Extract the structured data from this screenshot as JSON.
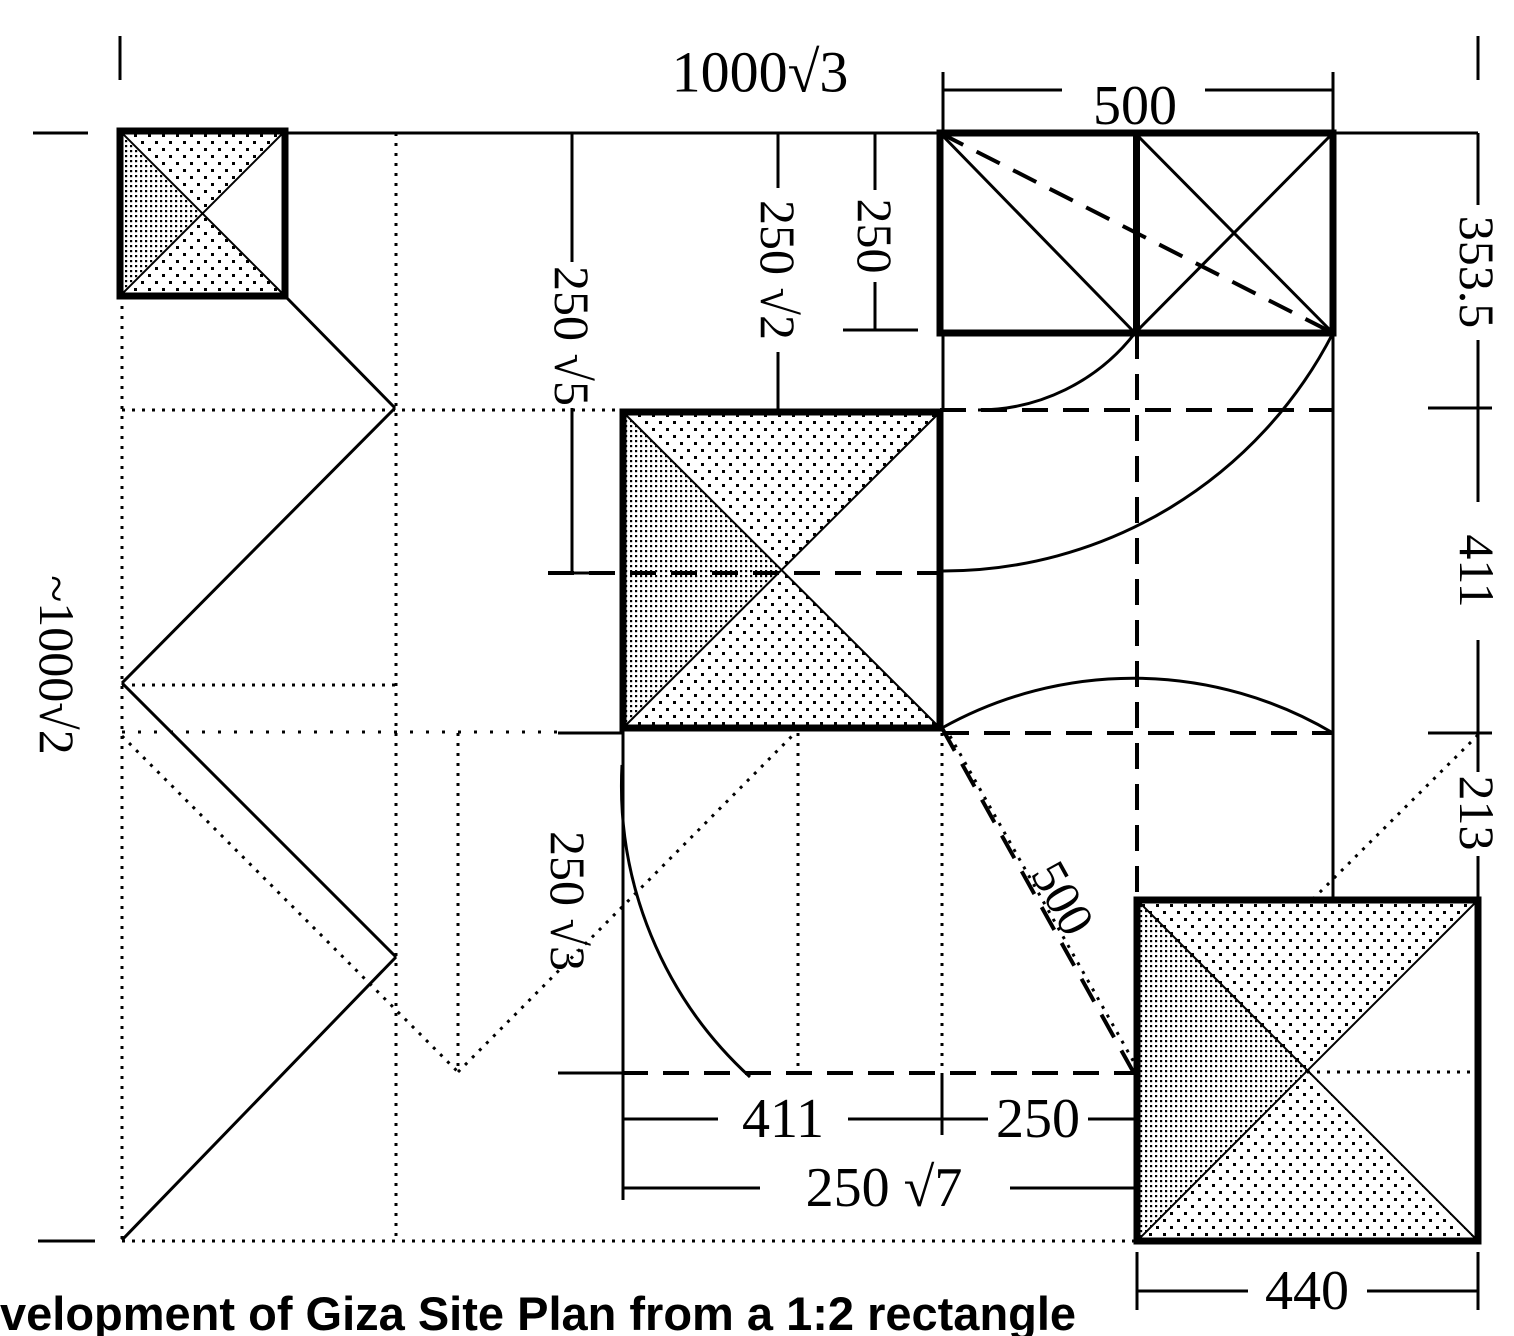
{
  "caption": "velopment of Giza Site Plan from a 1:2 rectangle",
  "colors": {
    "ink": "#000000",
    "background": "#ffffff"
  },
  "labels": {
    "top_width": "1000√3",
    "top_500": "500",
    "col_250sqrt5": "250 √5",
    "col_250sqrt2": "250 √2",
    "col_250": "250",
    "right_353_5": "353.5",
    "right_411": "411",
    "right_213": "213",
    "left_height": "~1000√2",
    "col_250sqrt3": "250 √3",
    "diag_500": "500",
    "bottom_411": "411",
    "bottom_250": "250",
    "bottom_250sqrt7": "250 √7",
    "bottom_440": "440"
  },
  "geometry": {
    "rects": [
      {
        "x": 940,
        "y": 133,
        "w": 393,
        "h": 200,
        "divider": true
      }
    ],
    "squares": [
      {
        "x": 120,
        "y": 131,
        "w": 165,
        "h": 165
      },
      {
        "x": 623,
        "y": 412,
        "w": 317,
        "h": 316
      },
      {
        "x": 1137,
        "y": 900,
        "w": 341,
        "h": 341
      }
    ],
    "lines": [
      {
        "x1": 33,
        "y1": 133,
        "x2": 88,
        "y2": 133,
        "s": "solid"
      },
      {
        "x1": 122,
        "y1": 133,
        "x2": 1478,
        "y2": 133,
        "s": "solid"
      },
      {
        "x1": 120,
        "y1": 36,
        "x2": 120,
        "y2": 80,
        "s": "solid"
      },
      {
        "x1": 1478,
        "y1": 36,
        "x2": 1478,
        "y2": 80,
        "s": "solid"
      },
      {
        "x1": 943,
        "y1": 72,
        "x2": 943,
        "y2": 133,
        "s": "solid"
      },
      {
        "x1": 1333,
        "y1": 72,
        "x2": 1333,
        "y2": 133,
        "s": "solid"
      },
      {
        "x1": 943,
        "y1": 90,
        "x2": 1062,
        "y2": 90,
        "s": "solid"
      },
      {
        "x1": 1205,
        "y1": 90,
        "x2": 1333,
        "y2": 90,
        "s": "solid"
      },
      {
        "x1": 875,
        "y1": 133,
        "x2": 875,
        "y2": 190,
        "s": "solid"
      },
      {
        "x1": 875,
        "y1": 282,
        "x2": 875,
        "y2": 330,
        "s": "solid"
      },
      {
        "x1": 843,
        "y1": 330,
        "x2": 918,
        "y2": 330,
        "s": "solid"
      },
      {
        "x1": 778,
        "y1": 133,
        "x2": 778,
        "y2": 188,
        "s": "solid"
      },
      {
        "x1": 778,
        "y1": 352,
        "x2": 778,
        "y2": 410,
        "s": "solid"
      },
      {
        "x1": 753,
        "y1": 410,
        "x2": 806,
        "y2": 410,
        "s": "solid"
      },
      {
        "x1": 572,
        "y1": 133,
        "x2": 572,
        "y2": 262,
        "s": "solid"
      },
      {
        "x1": 572,
        "y1": 408,
        "x2": 572,
        "y2": 573,
        "s": "solid"
      },
      {
        "x1": 548,
        "y1": 573,
        "x2": 600,
        "y2": 573,
        "s": "solid"
      },
      {
        "x1": 122,
        "y1": 410,
        "x2": 623,
        "y2": 410,
        "s": "dotted"
      },
      {
        "x1": 940,
        "y1": 410,
        "x2": 1333,
        "y2": 410,
        "s": "dashed"
      },
      {
        "x1": 548,
        "y1": 573,
        "x2": 940,
        "y2": 573,
        "s": "dashed"
      },
      {
        "x1": 122,
        "y1": 685,
        "x2": 396,
        "y2": 685,
        "s": "dotted"
      },
      {
        "x1": 122,
        "y1": 732,
        "x2": 560,
        "y2": 732,
        "s": "sparse"
      },
      {
        "x1": 558,
        "y1": 733,
        "x2": 622,
        "y2": 733,
        "s": "solid"
      },
      {
        "x1": 943,
        "y1": 733,
        "x2": 1333,
        "y2": 733,
        "s": "dashed"
      },
      {
        "x1": 558,
        "y1": 1073,
        "x2": 622,
        "y2": 1073,
        "s": "solid"
      },
      {
        "x1": 622,
        "y1": 1073,
        "x2": 1135,
        "y2": 1073,
        "s": "dashed"
      },
      {
        "x1": 1307,
        "y1": 1072,
        "x2": 1478,
        "y2": 1072,
        "s": "dotted"
      },
      {
        "x1": 122,
        "y1": 1241,
        "x2": 1137,
        "y2": 1241,
        "s": "dotted"
      },
      {
        "x1": 38,
        "y1": 1241,
        "x2": 95,
        "y2": 1241,
        "s": "solid"
      },
      {
        "x1": 122,
        "y1": 296,
        "x2": 122,
        "y2": 1241,
        "s": "dotted"
      },
      {
        "x1": 396,
        "y1": 133,
        "x2": 396,
        "y2": 1241,
        "s": "dotted"
      },
      {
        "x1": 458,
        "y1": 733,
        "x2": 458,
        "y2": 1072,
        "s": "dotted"
      },
      {
        "x1": 798,
        "y1": 733,
        "x2": 798,
        "y2": 1072,
        "s": "dotted"
      },
      {
        "x1": 943,
        "y1": 333,
        "x2": 943,
        "y2": 412,
        "s": "solid"
      },
      {
        "x1": 942,
        "y1": 733,
        "x2": 942,
        "y2": 1073,
        "s": "dotted"
      },
      {
        "x1": 942,
        "y1": 1073,
        "x2": 942,
        "y2": 1135,
        "s": "solid"
      },
      {
        "x1": 623,
        "y1": 728,
        "x2": 623,
        "y2": 1200,
        "s": "solid"
      },
      {
        "x1": 1137,
        "y1": 333,
        "x2": 1137,
        "y2": 898,
        "s": "dashed"
      },
      {
        "x1": 1333,
        "y1": 333,
        "x2": 1333,
        "y2": 898,
        "s": "solid"
      },
      {
        "x1": 1478,
        "y1": 133,
        "x2": 1478,
        "y2": 205,
        "s": "solid"
      },
      {
        "x1": 1478,
        "y1": 340,
        "x2": 1478,
        "y2": 502,
        "s": "solid"
      },
      {
        "x1": 1478,
        "y1": 640,
        "x2": 1478,
        "y2": 772,
        "s": "solid"
      },
      {
        "x1": 1478,
        "y1": 856,
        "x2": 1478,
        "y2": 898,
        "s": "solid"
      },
      {
        "x1": 1428,
        "y1": 408,
        "x2": 1492,
        "y2": 408,
        "s": "solid"
      },
      {
        "x1": 1428,
        "y1": 733,
        "x2": 1492,
        "y2": 733,
        "s": "solid"
      },
      {
        "x1": 623,
        "y1": 1119,
        "x2": 718,
        "y2": 1119,
        "s": "solid"
      },
      {
        "x1": 848,
        "y1": 1119,
        "x2": 988,
        "y2": 1119,
        "s": "solid"
      },
      {
        "x1": 1088,
        "y1": 1119,
        "x2": 1137,
        "y2": 1119,
        "s": "solid"
      },
      {
        "x1": 623,
        "y1": 1188,
        "x2": 760,
        "y2": 1188,
        "s": "solid"
      },
      {
        "x1": 1010,
        "y1": 1188,
        "x2": 1137,
        "y2": 1188,
        "s": "solid"
      },
      {
        "x1": 1137,
        "y1": 1291,
        "x2": 1248,
        "y2": 1291,
        "s": "solid"
      },
      {
        "x1": 1367,
        "y1": 1291,
        "x2": 1478,
        "y2": 1291,
        "s": "solid"
      },
      {
        "x1": 1137,
        "y1": 1252,
        "x2": 1137,
        "y2": 1310,
        "s": "solid"
      },
      {
        "x1": 1478,
        "y1": 1252,
        "x2": 1478,
        "y2": 1310,
        "s": "solid"
      },
      {
        "x1": 285,
        "y1": 296,
        "x2": 395,
        "y2": 408,
        "s": "solid"
      },
      {
        "x1": 395,
        "y1": 408,
        "x2": 122,
        "y2": 683,
        "s": "solid"
      },
      {
        "x1": 122,
        "y1": 683,
        "x2": 396,
        "y2": 957,
        "s": "solid"
      },
      {
        "x1": 396,
        "y1": 957,
        "x2": 122,
        "y2": 1240,
        "s": "solid"
      },
      {
        "x1": 940,
        "y1": 133,
        "x2": 1135,
        "y2": 333,
        "s": "solid"
      },
      {
        "x1": 1135,
        "y1": 133,
        "x2": 1333,
        "y2": 333,
        "s": "solid"
      },
      {
        "x1": 1135,
        "y1": 333,
        "x2": 1333,
        "y2": 133,
        "s": "solid"
      },
      {
        "x1": 940,
        "y1": 133,
        "x2": 1333,
        "y2": 333,
        "s": "dashed"
      },
      {
        "x1": 942,
        "y1": 728,
        "x2": 1135,
        "y2": 1075,
        "s": "dashed"
      },
      {
        "x1": 950,
        "y1": 736,
        "x2": 1140,
        "y2": 1073,
        "s": "dotted"
      },
      {
        "x1": 122,
        "y1": 736,
        "x2": 458,
        "y2": 1072,
        "s": "dotted"
      },
      {
        "x1": 458,
        "y1": 1072,
        "x2": 795,
        "y2": 733,
        "s": "dotted"
      },
      {
        "x1": 1478,
        "y1": 735,
        "x2": 1312,
        "y2": 900,
        "s": "dotted"
      }
    ],
    "arcs": [
      {
        "d": "M 978 410 A 199 199 0 0 0 1135 333"
      },
      {
        "d": "M 940 571 A 438 438 0 0 0 1333 333"
      },
      {
        "d": "M 942 728 A 392 392 0 0 1 1333 733"
      },
      {
        "d": "M 622 765 A 395 395 0 0 0 750 1077"
      }
    ]
  }
}
